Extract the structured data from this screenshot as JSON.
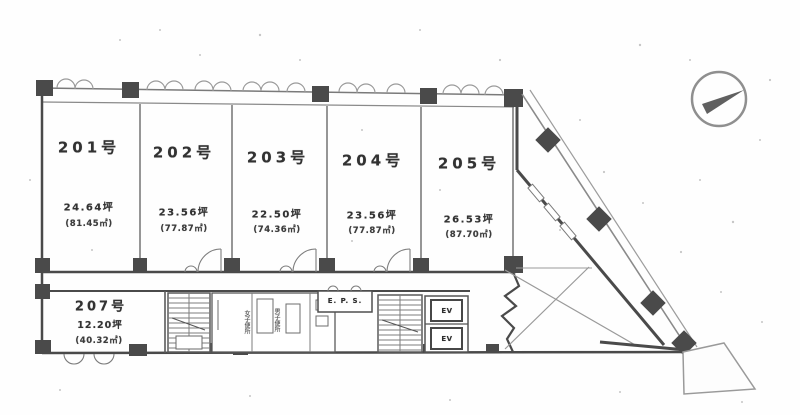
{
  "plan": {
    "rooms": [
      {
        "number": "201号",
        "tsubo": "24.64坪",
        "sqm": "(81.45㎡)"
      },
      {
        "number": "202号",
        "tsubo": "23.56坪",
        "sqm": "(77.87㎡)"
      },
      {
        "number": "203号",
        "tsubo": "22.50坪",
        "sqm": "(74.36㎡)"
      },
      {
        "number": "204号",
        "tsubo": "23.56坪",
        "sqm": "(77.87㎡)"
      },
      {
        "number": "205号",
        "tsubo": "26.53坪",
        "sqm": "(87.70㎡)"
      },
      {
        "number": "207号",
        "tsubo": "12.20坪",
        "sqm": "(40.32㎡)"
      }
    ],
    "core": {
      "eps": "E. P. S.",
      "ev": "EV",
      "toilets": [
        "女子便所",
        "男子便所"
      ]
    },
    "icons": {
      "compass": "north-compass"
    },
    "colors": {
      "wall": "#4a4a4a",
      "line": "#8f8f8f",
      "text": "#323232",
      "background": "#fefefe"
    }
  }
}
